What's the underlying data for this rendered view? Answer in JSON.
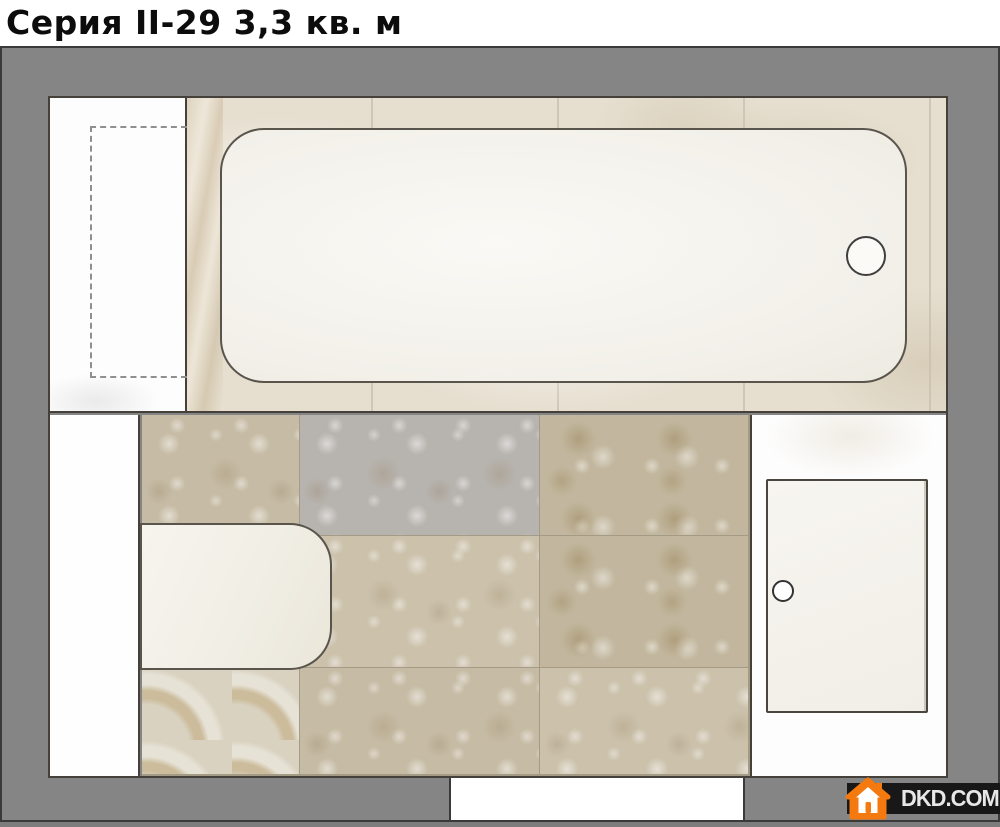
{
  "title": "Серия II-29 3,3 кв. м",
  "watermark": {
    "label": "DKD.COM.UA",
    "icon": "house-icon"
  },
  "theme": {
    "wall": "#858585",
    "wall_dark": "#3a3a3a",
    "outline": "#45413a",
    "fixture_fill": "#f5f3ed",
    "floor_joint": "#a49b86",
    "tile_light": "#e6dfd0",
    "accent_orange": "#f4790f",
    "watermark_bar": "#181818",
    "watermark_text": "#e8e8e8"
  },
  "plan": {
    "shapes": [
      "bathtub",
      "bathtub-drain",
      "appliance-placeholder-dashed",
      "washbasin",
      "fixture-with-knob",
      "door-opening"
    ]
  }
}
